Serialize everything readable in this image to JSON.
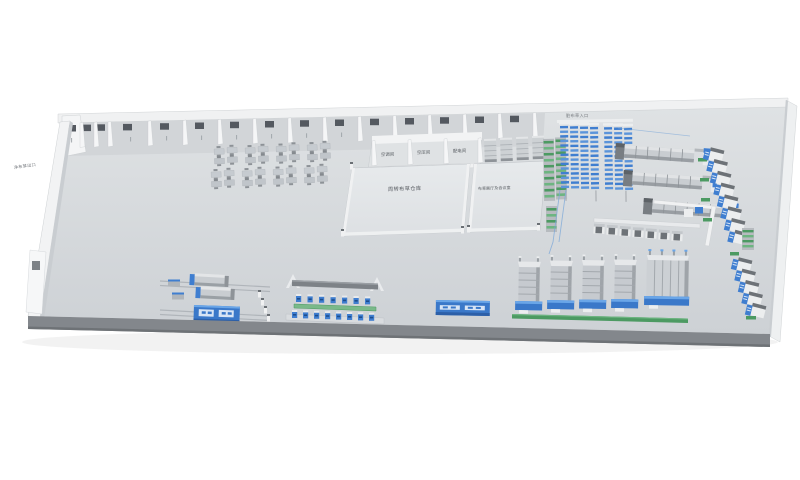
{
  "scene": {
    "description": "isometric-3d-factory-floor-plan",
    "colors": {
      "background": "#ffffff",
      "floor": "#d6d9dc",
      "wall": "#f2f3f4",
      "front_apron": "#83878c",
      "machine_gray": "#c6cacf",
      "accent_blue": "#3f7ed0",
      "accent_blue_dark": "#2c5fa8",
      "accent_green": "#4c9a62",
      "label_gray": "#74787d"
    }
  },
  "labels": {
    "exit_left": "净布草出口",
    "dirty_linen_entrance": "脏布草入口",
    "utility_rooms": [
      "空调间",
      "空压间",
      "配电间"
    ],
    "warehouse": "周转布草仓库",
    "showroom": "布草展厅及会议室"
  },
  "equipment": {
    "office_desk_clusters": 8,
    "utility_rooms": 3,
    "tunnel_washer_lines": 3,
    "blue_sorter_columns": 7,
    "gray_storage_racks": 4,
    "green_rack_columns": 3,
    "press_units_row": 7,
    "wall_washers_upper": 8,
    "wall_washers_lower": 5,
    "folder_machines": 4,
    "wide_folder_machines": 1,
    "workstations_top_row": 7,
    "workstations_bottom_row": 8,
    "dryer_cylinders": 2
  }
}
